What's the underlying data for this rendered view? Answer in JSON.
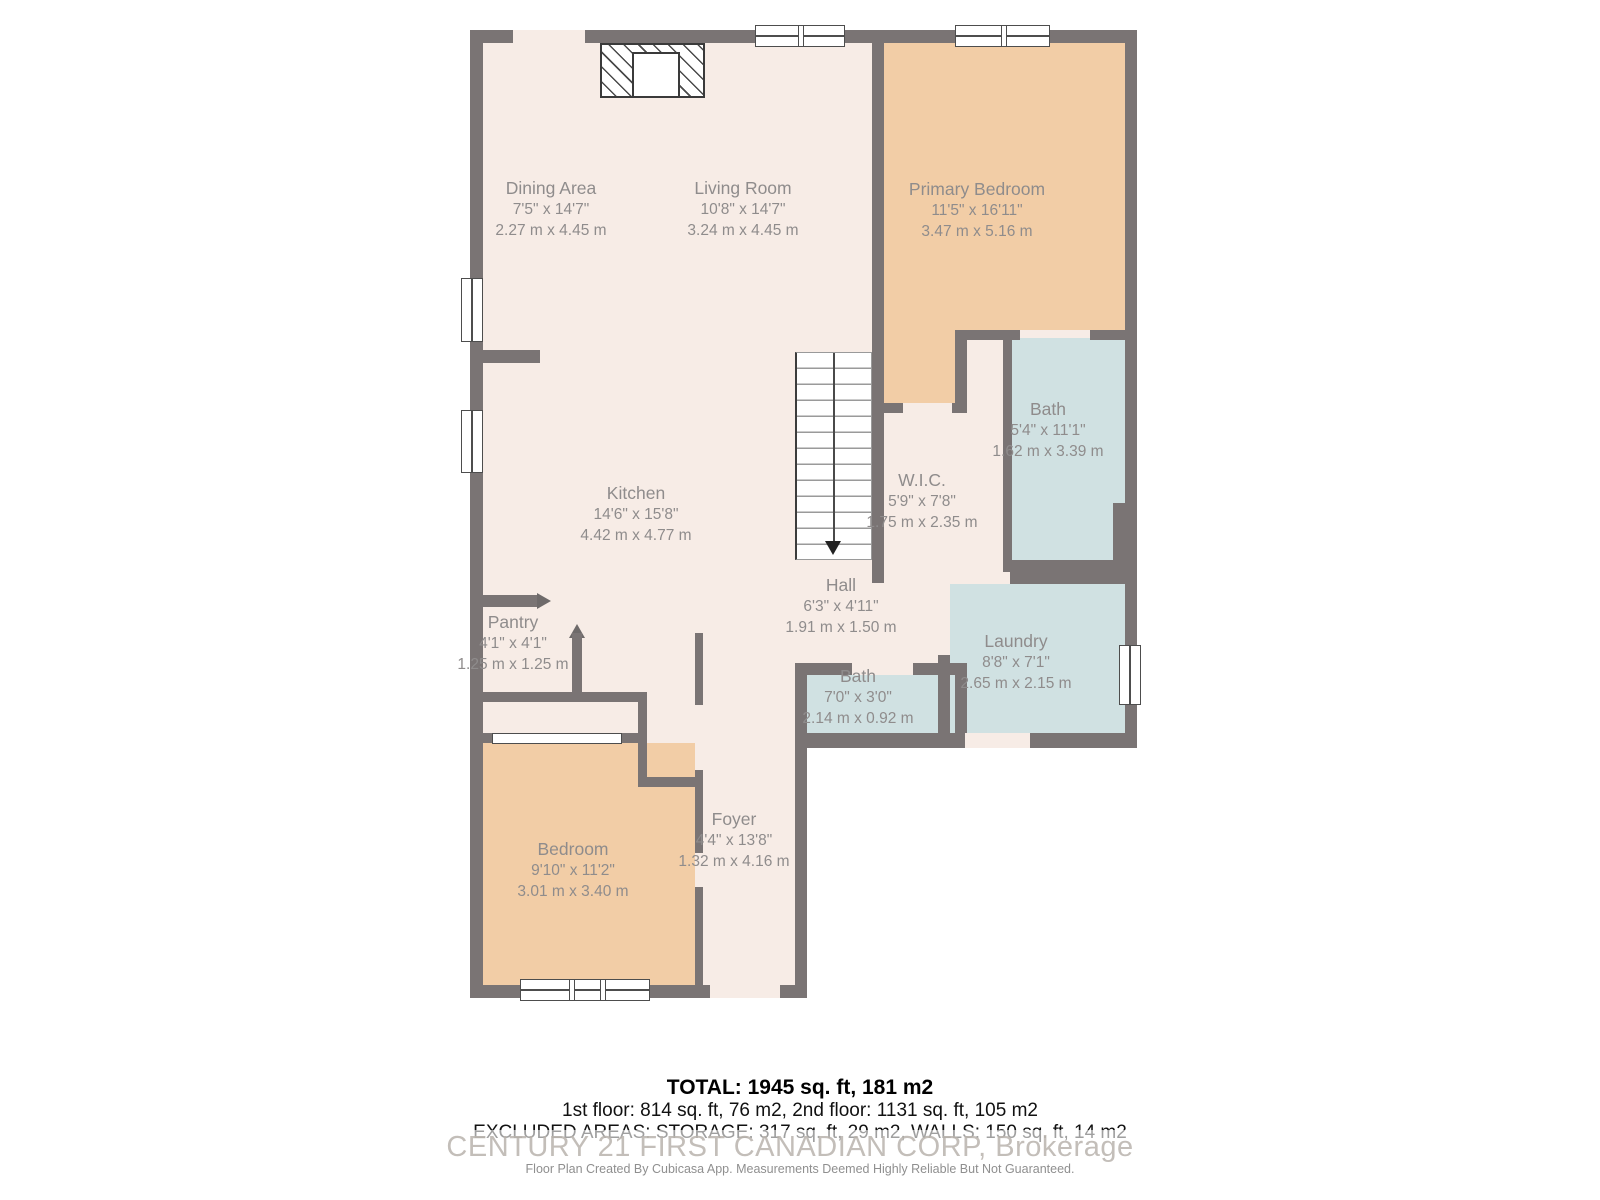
{
  "rooms": {
    "dining": {
      "name": "Dining Area",
      "dim_ft": "7'5\" x 14'7\"",
      "dim_m": "2.27 m x 4.45 m"
    },
    "living": {
      "name": "Living Room",
      "dim_ft": "10'8\" x 14'7\"",
      "dim_m": "3.24 m x 4.45 m"
    },
    "primary_bedroom": {
      "name": "Primary Bedroom",
      "dim_ft": "11'5\" x 16'11\"",
      "dim_m": "3.47 m x 5.16 m"
    },
    "bath_upper": {
      "name": "Bath",
      "dim_ft": "5'4\" x 11'1\"",
      "dim_m": "1.62 m x 3.39 m"
    },
    "wic": {
      "name": "W.I.C.",
      "dim_ft": "5'9\" x 7'8\"",
      "dim_m": "1.75 m x 2.35 m"
    },
    "kitchen": {
      "name": "Kitchen",
      "dim_ft": "14'6\" x 15'8\"",
      "dim_m": "4.42 m x 4.77 m"
    },
    "hall": {
      "name": "Hall",
      "dim_ft": "6'3\" x 4'11\"",
      "dim_m": "1.91 m x 1.50 m"
    },
    "pantry": {
      "name": "Pantry",
      "dim_ft": "4'1\" x 4'1\"",
      "dim_m": "1.25 m x 1.25 m"
    },
    "laundry": {
      "name": "Laundry",
      "dim_ft": "8'8\" x 7'1\"",
      "dim_m": "2.65 m x 2.15 m"
    },
    "bath_main": {
      "name": "Bath",
      "dim_ft": "7'0\" x 3'0\"",
      "dim_m": "2.14 m x 0.92 m"
    },
    "bedroom": {
      "name": "Bedroom",
      "dim_ft": "9'10\" x 11'2\"",
      "dim_m": "3.01 m x 3.40 m"
    },
    "foyer": {
      "name": "Foyer",
      "dim_ft": "4'4\" x 13'8\"",
      "dim_m": "1.32 m x 4.16 m"
    }
  },
  "summary": {
    "total": "TOTAL: 1945 sq. ft, 181 m2",
    "floors": "1st floor: 814 sq. ft, 76 m2, 2nd floor: 1131 sq. ft, 105 m2",
    "excluded": "EXCLUDED AREAS: STORAGE: 317 sq. ft, 29 m2, WALLS: 150 sq. ft, 14 m2"
  },
  "watermark": "CENTURY 21 FIRST CANADIAN CORP, Brokerage",
  "disclaimer": "Floor Plan Created By Cubicasa App. Measurements Deemed Highly Reliable But Not Guaranteed.",
  "colors": {
    "wall": "#7a7474",
    "floor": "#f7ece6",
    "bedroom_fill": "#f2cda6",
    "wet_room_fill": "#d0e1e2",
    "label_text": "#8f8c8c"
  }
}
